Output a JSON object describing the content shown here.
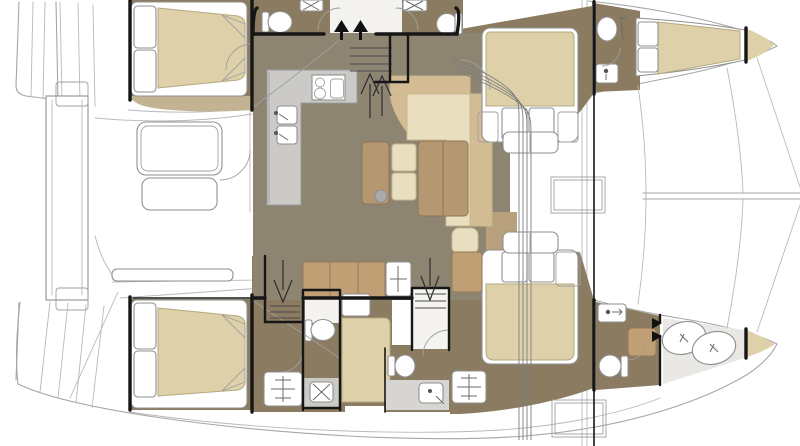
{
  "diagram": {
    "title": "Catamaran interior and deck floor plan",
    "type": "yacht-floor-plan",
    "orientation": "bows-to-right",
    "view": "overhead cutaway"
  },
  "colors": {
    "background": "#ffffff",
    "deck_white": "#ffffff",
    "salon_floor": "#8e8472",
    "hull_floor": "#8b7b61",
    "corridor_floor": "#f4f3ef",
    "head_light_floor": "#e9e8e4",
    "counter_gray": "#cbcac6",
    "shower_gray": "#d6d5d1",
    "mattress_beige": "#ded1a9",
    "tan_band": "#c3b392",
    "wood_brown": "#b59872",
    "cream": "#e9dec0",
    "sofa_tan": "#d3bc93",
    "cabinet_tan": "#c19f74",
    "walkway_tan": "#b9a07c",
    "white": "#ffffff",
    "bulkhead_black": "#161616",
    "outline_gray": "#a6a6a6"
  },
  "rooms": [
    {
      "id": "aft-cockpit",
      "label": "Aft cockpit with table and bench"
    },
    {
      "id": "swim-platform",
      "label": "Transom steps and swim platform"
    },
    {
      "id": "salon",
      "label": "Salon lounge"
    },
    {
      "id": "galley",
      "label": "L-shaped galley with cooktop and double sink"
    },
    {
      "id": "port-aft-cabin",
      "label": "Port aft double cabin"
    },
    {
      "id": "port-hull-heads",
      "label": "Port hull heads with toilets and sinks"
    },
    {
      "id": "port-forward-cabin",
      "label": "Port forward double cabin"
    },
    {
      "id": "port-forward-head",
      "label": "Port forward head"
    },
    {
      "id": "bow-berth",
      "label": "Port bow berth"
    },
    {
      "id": "starboard-aft-cabin",
      "label": "Starboard aft double cabin"
    },
    {
      "id": "starboard-aft-head",
      "label": "Starboard aft head with shower"
    },
    {
      "id": "single-berth-cabin",
      "label": "Starboard single berth"
    },
    {
      "id": "starboard-forward-wc",
      "label": "Starboard forward WC and shower"
    },
    {
      "id": "starboard-forward-cabin",
      "label": "Starboard forward double cabin"
    },
    {
      "id": "starboard-forward-head",
      "label": "Starboard forward head"
    },
    {
      "id": "bow-shower-room",
      "label": "Starboard bow shower room"
    },
    {
      "id": "foredeck",
      "label": "Foredeck, trampoline and bowsprit"
    }
  ],
  "fixtures": {
    "toilets": 6,
    "sinks": 8,
    "showers": 2,
    "double_beds": 4,
    "single_berths": 2,
    "cooktop_burners": 2,
    "companionway_arrows": 3,
    "deck_hatches": 2,
    "cockpit_tables": 1
  }
}
